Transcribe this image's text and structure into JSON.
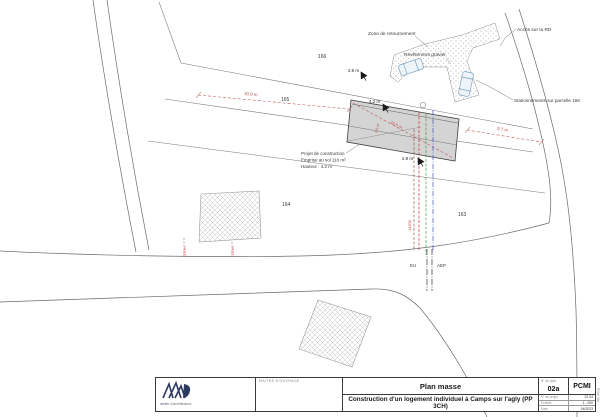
{
  "colors": {
    "line": "#6a6a6a",
    "building_fill": "#d4d4d4",
    "building_stroke": "#3f3f3f",
    "dim_red": "#c05050",
    "util_maroon": "#9b5a50",
    "util_red": "#cc3333",
    "util_green": "#3f9b4f",
    "util_blue": "#4054c0",
    "car": "#7aa3c4",
    "logo_navy": "#2b3a5e"
  },
  "plan": {
    "parcels": {
      "p166": "166",
      "p165": "165",
      "p164": "164",
      "p163": "163"
    },
    "labels": {
      "zone": "Zone de retournement",
      "gravier": "Revêtement gravier",
      "acces": "Accès sur la RD",
      "stationnements": "Stationnements sur parcelle 166",
      "projet1": "Projet de construction",
      "projet2": "Emprise au sol 110 m²",
      "projet3": "Hauteur : 4.2 m",
      "eu": "EU",
      "aep": "AEP"
    },
    "dims": {
      "d309": "30.9 m",
      "d97": "9.7 m",
      "d42": "4.2 m",
      "d160": "16.0 m",
      "d29_top": "2.9 m",
      "d29_mid": "2.9 m",
      "d14500": "14500",
      "d29_left": "2.9 m",
      "d15_left": "1.5 m",
      "d46": "4.6 m"
    }
  },
  "title_block": {
    "client_label": "MAITRE D'OUVRAGE",
    "title": "Plan masse",
    "subtitle": "Construction d'un logement individuel à Camps sur l'agly (PP 3CH)",
    "plan_no_label": "N° de plan",
    "plan_no": "02a",
    "doc_type": "PCMI",
    "meta1_label": "N° de projet",
    "meta1_value": "22 04",
    "meta2_label": "Echelle",
    "meta2_value": "1 : 200",
    "meta3_label": "Date",
    "meta3_value": "04/2023",
    "logo_caption": "atelier d'architecture",
    "side_ref": "PCMI 02a"
  }
}
